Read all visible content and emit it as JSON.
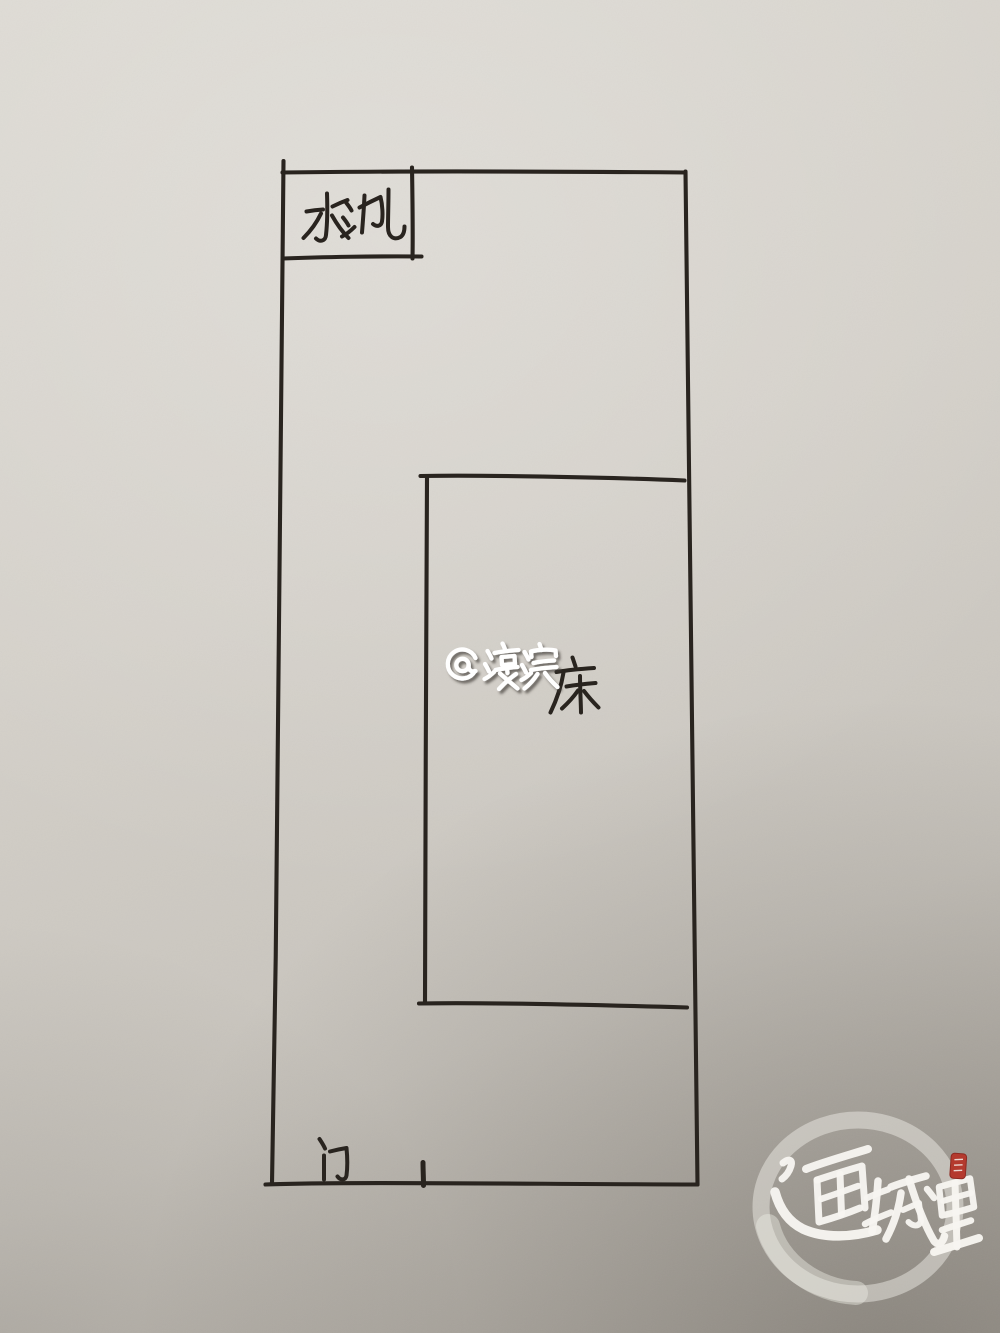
{
  "page": {
    "title": "Hand-drawn room floor plan on paper"
  },
  "paper": {
    "base_color": "#d2cec7",
    "highlight_color": "#dcd9d2",
    "shadow_color": "#aca79f",
    "ink_color": "#29241f"
  },
  "floorplan": {
    "sink_label": "水池",
    "bed_label": "床",
    "door_label": "门"
  },
  "watermark": {
    "text": "@濠滨",
    "color": "#ffffff"
  },
  "logo": {
    "text": "通城里",
    "color": "#f7f5f0",
    "ring_color": "#eceae3",
    "seal_color": "#b43a2e"
  }
}
